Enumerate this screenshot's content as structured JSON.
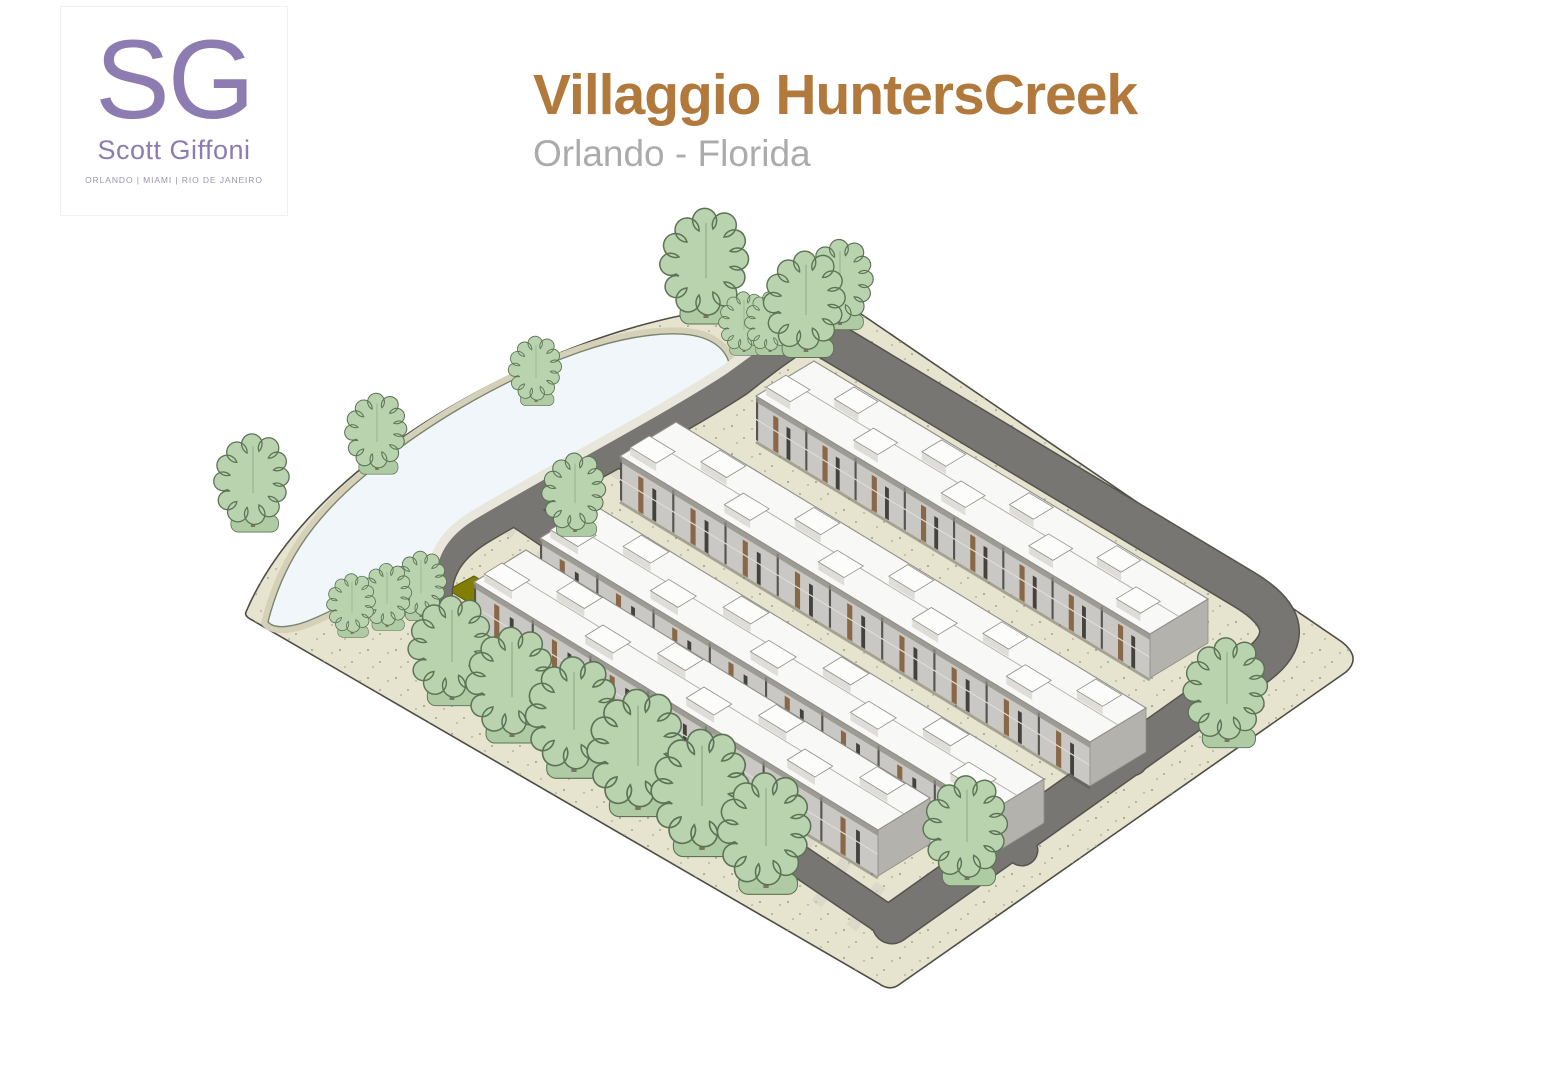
{
  "slide": {
    "title": "Villaggio HuntersCreek",
    "subtitle": "Orlando - Florida"
  },
  "logo": {
    "initials": "SG",
    "name": "Scott Giffoni",
    "cities": "ORLANDO  |  MIAMI  |  RIO DE JANEIRO"
  },
  "palette": {
    "page_bg": "#FFFFFF",
    "title_brown": "#B1793C",
    "subtitle_gray": "#ABABAB",
    "logo_purple": "#8C7CB1",
    "logo_cities": "#9B93AE",
    "ground": "#E6E3CF",
    "ground_speckle": "#ABA78D",
    "ground_outline": "#4E4D44",
    "pond_fill": "#F0F6F9",
    "pond_edge": "#7A856F",
    "pond_rim": "#D5D1B8",
    "road_fill": "#777672",
    "road_edge": "#55544E",
    "sidewalk": "#E9E7DC",
    "driveway": "#D3D1C6",
    "roof_white": "#F8F8F6",
    "roof_line": "#8F8E88",
    "roof_box_top": "#FCFCFA",
    "roof_box_side": "#DEDDD7",
    "wall_gray": "#C9C8C4",
    "wall_top_shadow": "#8E8C84",
    "wall_divider": "#57554F",
    "wall_brown": "#8A6847",
    "window_dark": "#44423C",
    "floor_line": "#DDDCD6",
    "cap_gray": "#B3B2AC",
    "ridge_line": "#B5B4AC",
    "ground_shadow": "#55544C",
    "olive_green": "#827E04",
    "pool_blue": "#7FB6CF",
    "tree_fill": "#B9D3AF",
    "tree_shade": "#9CBB93",
    "tree_outline": "#5C7356",
    "tree_trunk": "#7D7463",
    "tree_base": "#AECBA4"
  },
  "scene": {
    "site": "M 246,612 C 270,555 320,498 385,450 C 450,402 535,358 618,332 C 695,308 775,298 845,303 L 1342,642 Q 1362,658 1346,672 L 900,984 Q 890,992 878,983 L 252,620 Q 244,616 246,612 Z",
    "pond": "M 268,622 C 282,566 310,522 362,478 C 420,428 500,380 580,352 C 635,333 680,330 703,338 C 723,345 733,360 729,378 C 725,395 705,412 668,432 C 600,468 520,508 448,548 C 400,575 345,605 315,618 C 295,627 275,630 268,622 Z",
    "sidewalk": "M 800,318 C 766,338 744,356 724,370 C 660,412 552,468 472,516 C 446,532 430,554 432,584",
    "roads": [
      {
        "d": "M 812,330 L 1245,590 Q 1308,628 1256,666 L 892,924",
        "w": 38,
        "drive": false
      },
      {
        "d": "M 818,326 C 780,348 760,365 738,382 C 672,425 560,482 480,530 C 448,550 434,574 438,606 L 444,620",
        "w": 28,
        "drive": false
      },
      {
        "d": "M 444,620 L 892,924",
        "w": 30,
        "drive": true
      },
      {
        "d": "M 516,510 L 1022,850",
        "w": 30,
        "drive": true
      },
      {
        "d": "M 622,452 L 1132,760",
        "w": 30,
        "drive": true
      }
    ],
    "olive": "448,590 474,576 544,618 518,632",
    "pool": "424,640 434,634 456,647 446,653",
    "rows": [
      {
        "x1": 756,
        "y1": 440,
        "x2": 1150,
        "y2": 678,
        "h": 44,
        "dep": [
          58,
          -35
        ],
        "units": 8,
        "boxes": 9
      },
      {
        "x1": 620,
        "y1": 500,
        "x2": 1090,
        "y2": 786,
        "h": 44,
        "dep": [
          56,
          -34
        ],
        "units": 9,
        "boxes": 10
      },
      {
        "x1": 540,
        "y1": 582,
        "x2": 990,
        "y2": 856,
        "h": 44,
        "dep": [
          54,
          -33
        ],
        "units": 8,
        "boxes": 9
      },
      {
        "x1": 474,
        "y1": 628,
        "x2": 878,
        "y2": 876,
        "h": 46,
        "dep": [
          52,
          -32
        ],
        "units": 7,
        "boxes": 8
      }
    ],
    "trees": [
      [
        706,
        318,
        1.0
      ],
      [
        744,
        352,
        0.55
      ],
      [
        770,
        352,
        0.55
      ],
      [
        806,
        352,
        0.92
      ],
      [
        840,
        325,
        0.78
      ],
      [
        536,
        402,
        0.6
      ],
      [
        253,
        527,
        0.85
      ],
      [
        377,
        470,
        0.7
      ],
      [
        352,
        634,
        0.55
      ],
      [
        387,
        627,
        0.58
      ],
      [
        421,
        617,
        0.6
      ],
      [
        575,
        532,
        0.72
      ],
      [
        452,
        700,
        0.95
      ],
      [
        512,
        737,
        1.0
      ],
      [
        574,
        772,
        1.05
      ],
      [
        638,
        810,
        1.1
      ],
      [
        702,
        850,
        1.1
      ],
      [
        766,
        888,
        1.05
      ],
      [
        1227,
        742,
        0.95
      ],
      [
        967,
        880,
        0.95
      ]
    ]
  }
}
